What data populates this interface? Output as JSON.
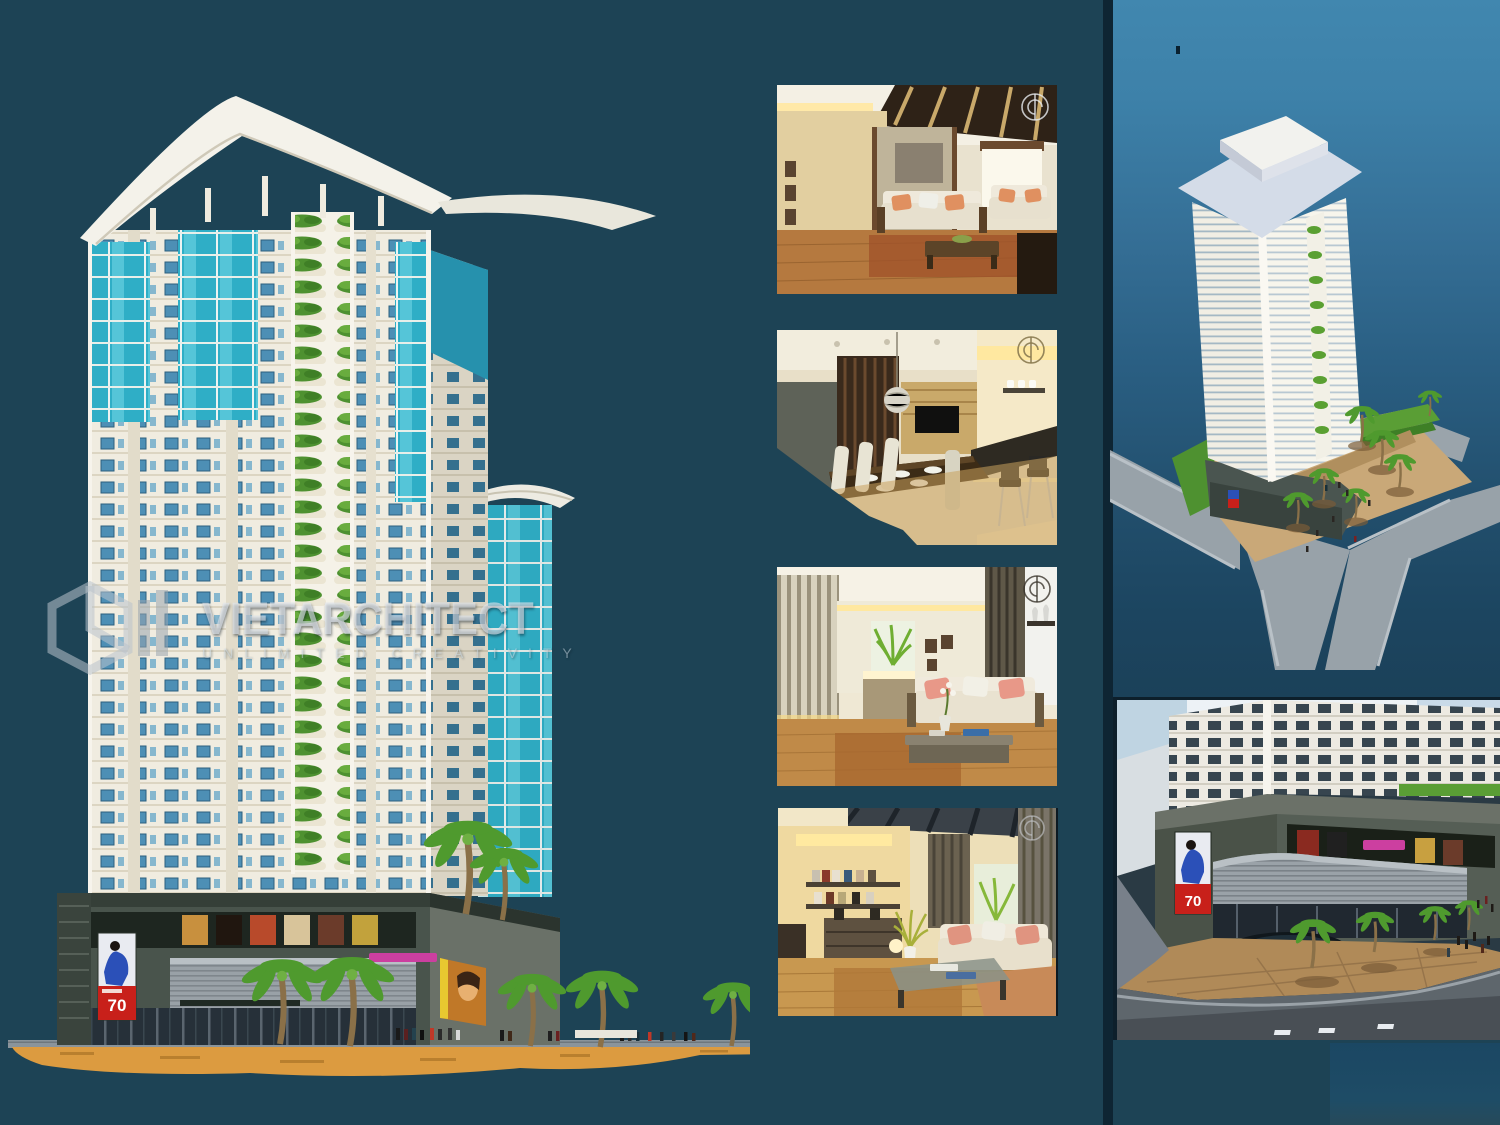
{
  "board": {
    "background_color": "#1D4355",
    "right_panel_top_color": "#4187AF",
    "right_panel_bottom_color": "#1B4159"
  },
  "watermark": {
    "logo": "hexagon-monogram",
    "brand": "VIETARCHITECT",
    "tagline": "UNLIMITED CREATIVITY"
  },
  "renders": {
    "main_elevation": {
      "label": "tower-street-elevation",
      "sale_poster_text": "70",
      "facade_color": "#F0ECE0",
      "glass_color": "#2FAEC6",
      "podium_color": "#49544C",
      "plaza_sign_color": "#CC3FA0",
      "sand_color": "#DC9B40"
    },
    "interiors": [
      {
        "label": "living-room-beamed-ceiling",
        "corner_mark": "architect-monogram"
      },
      {
        "label": "dining-room-and-bar",
        "corner_mark": "architect-monogram"
      },
      {
        "label": "lounge-with-slat-wall",
        "corner_mark": "architect-monogram"
      },
      {
        "label": "family-room-with-bookshelf",
        "corner_mark": "architect-monogram"
      }
    ],
    "aerial_view": {
      "label": "tower-aerial-perspective"
    },
    "street_view": {
      "label": "podium-corner-street-view",
      "sale_poster_text": "70"
    }
  }
}
